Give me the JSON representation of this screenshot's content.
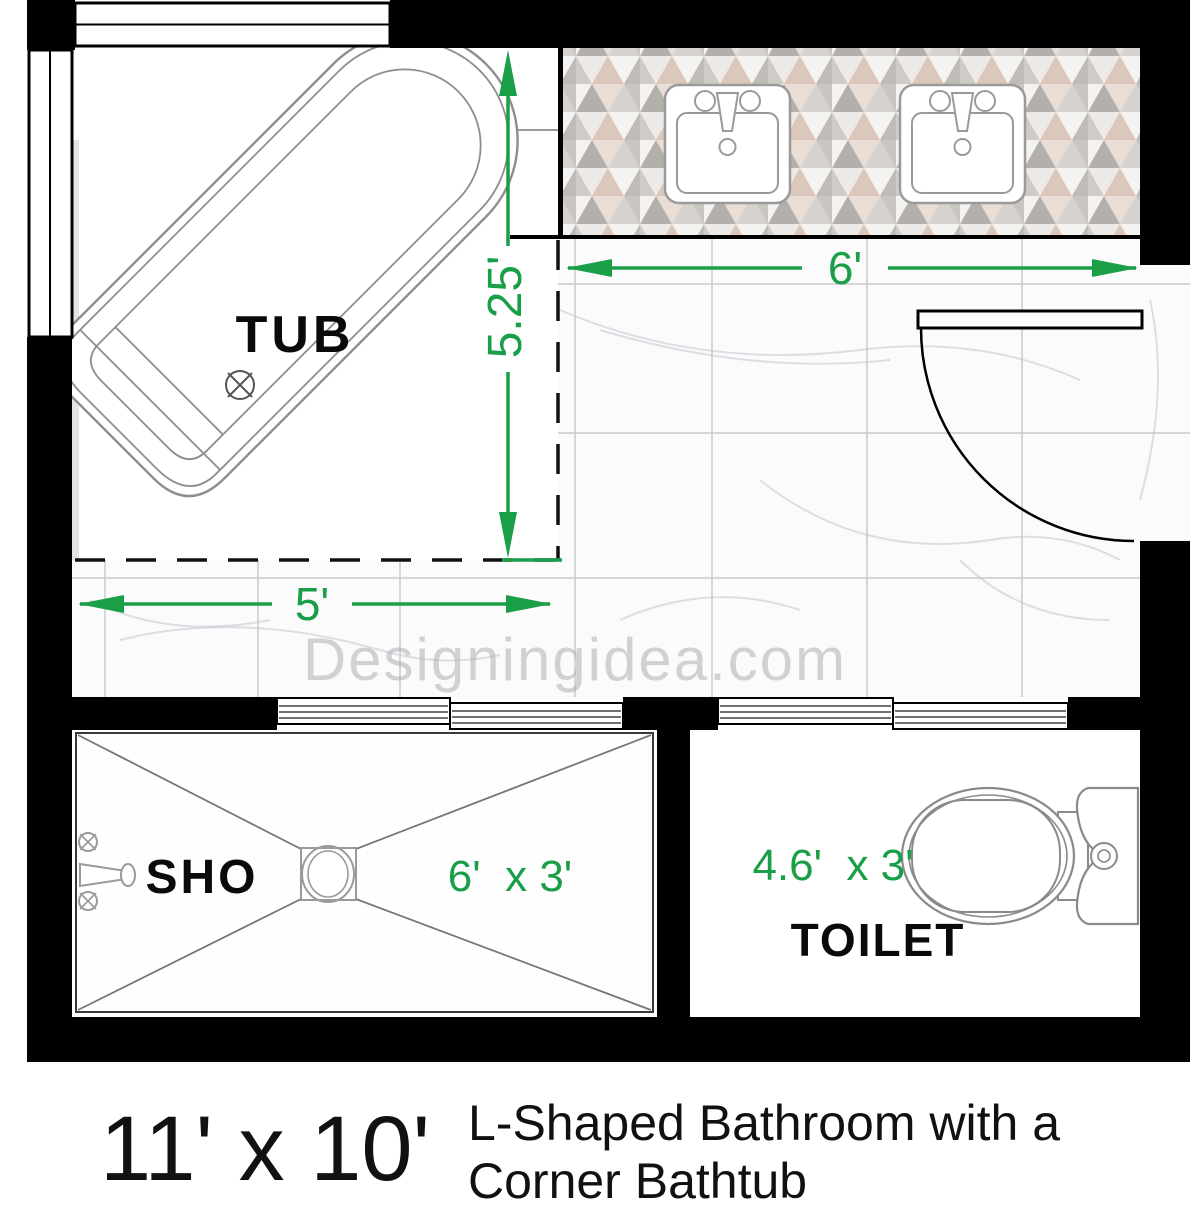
{
  "plan": {
    "watermark": "Designingidea.com",
    "labels": {
      "tub": "TUB",
      "shower": "SHO",
      "toilet": "TOILET"
    },
    "dimensions": {
      "tub_zone_width": "5'",
      "tub_zone_depth": "5.25'",
      "vanity_width": "6'",
      "shower_size": "6'  x 3'",
      "toilet_size": "4.6'  x 3'"
    }
  },
  "caption": {
    "room_size": "11' x 10'",
    "title_line1": "L-Shaped Bathroom with a",
    "title_line2": "Corner Bathtub"
  },
  "colors": {
    "wall": "#000000",
    "dimension_green": "#1a9e47",
    "fixture_outline": "#8a8a8a",
    "watermark_gray": "#a9a9ad",
    "mosaic_beige": "#dcc8ba",
    "mosaic_gray": "#b3b0ac"
  }
}
